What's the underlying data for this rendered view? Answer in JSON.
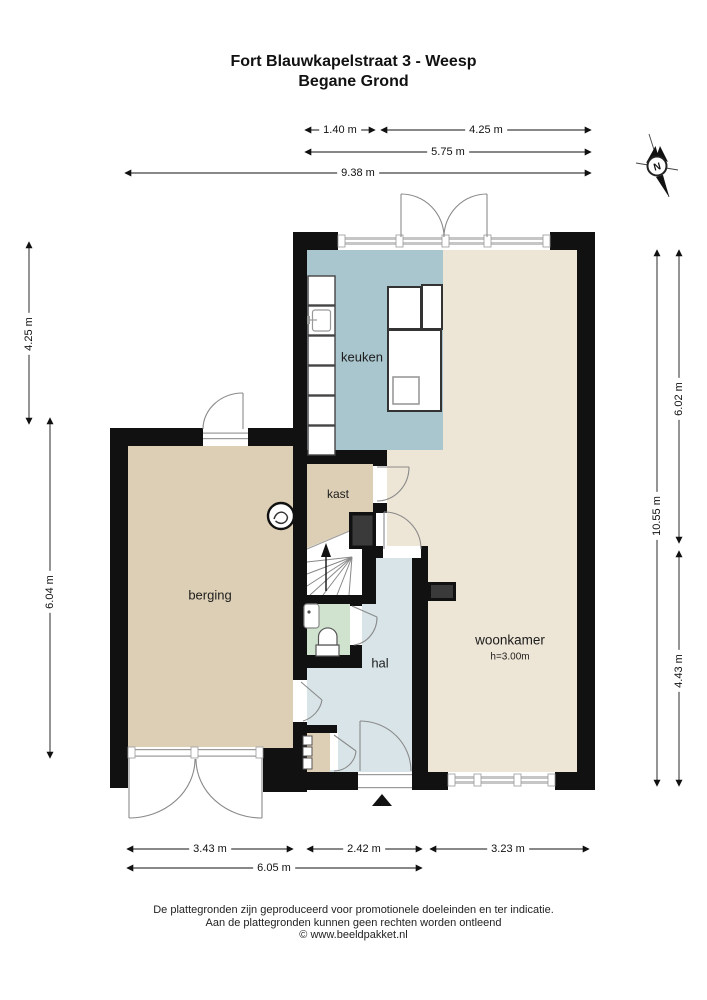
{
  "title": {
    "line1": "Fort Blauwkapelstraat 3 - Weesp",
    "line2": "Begane Grond"
  },
  "compass": {
    "north_label": "N"
  },
  "rooms": [
    {
      "id": "keuken",
      "label": "keuken"
    },
    {
      "id": "kast",
      "label": "kast"
    },
    {
      "id": "berging",
      "label": "berging"
    },
    {
      "id": "hal",
      "label": "hal"
    },
    {
      "id": "woonkamer",
      "label": "woonkamer",
      "height_label": "h=3.00m"
    }
  ],
  "dimensions": {
    "top": [
      "1.40 m",
      "4.25 m",
      "5.75 m",
      "9.38 m"
    ],
    "left": [
      "4.25 m",
      "6.04 m"
    ],
    "right": [
      "6.02 m",
      "10.55 m",
      "4.43 m"
    ],
    "bottom": [
      "3.43 m",
      "2.42 m",
      "3.23 m",
      "6.05 m"
    ]
  },
  "footer": [
    "De plattegronden zijn geproduceerd voor promotionele doeleinden en ter indicatie.",
    "Aan de plattegronden kunnen geen rechten worden ontleend",
    "© www.beeldpakket.nl"
  ],
  "colors": {
    "wall": "#111111",
    "keuken_floor": "#a9c5cd",
    "woonkamer_floor": "#ede5d6",
    "berging_floor": "#ddcfb5",
    "hal_floor": "#d8e4e8",
    "wc_floor": "#cfe3cf",
    "window_band": "#c6c6c6",
    "duct_fill": "#3a3a3a"
  }
}
